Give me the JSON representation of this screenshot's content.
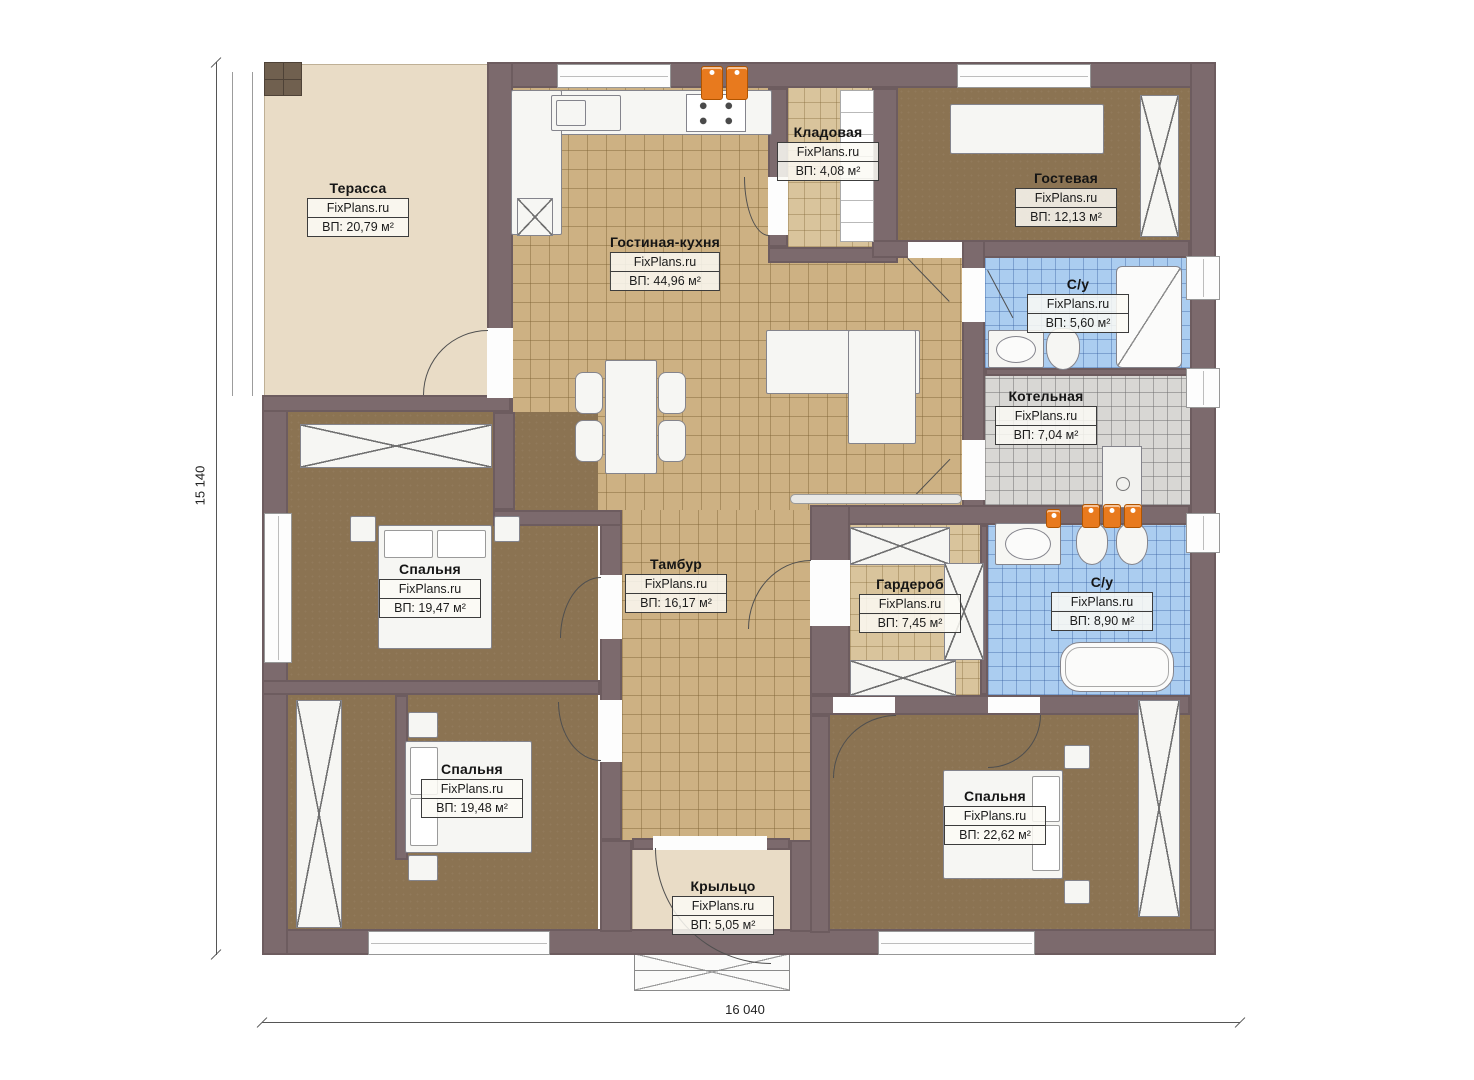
{
  "brand": "FixPlans.ru",
  "dimensions": {
    "height_label": "15 140",
    "width_label": "16 040"
  },
  "rooms": [
    {
      "name": "Терасса",
      "brand": "FixPlans.ru",
      "area": "ВП: 20,79 м²"
    },
    {
      "name": "Гостиная-кухня",
      "brand": "FixPlans.ru",
      "area": "ВП: 44,96 м²"
    },
    {
      "name": "Кладовая",
      "brand": "FixPlans.ru",
      "area": "ВП: 4,08 м²"
    },
    {
      "name": "Гостевая",
      "brand": "FixPlans.ru",
      "area": "ВП: 12,13 м²"
    },
    {
      "name": "С/у",
      "brand": "FixPlans.ru",
      "area": "ВП: 5,60 м²"
    },
    {
      "name": "Котельная",
      "brand": "FixPlans.ru",
      "area": "ВП: 7,04 м²"
    },
    {
      "name": "Спальня",
      "brand": "FixPlans.ru",
      "area": "ВП: 19,47 м²"
    },
    {
      "name": "Тамбур",
      "brand": "FixPlans.ru",
      "area": "ВП: 16,17 м²"
    },
    {
      "name": "Гардероб",
      "brand": "FixPlans.ru",
      "area": "ВП: 7,45 м²"
    },
    {
      "name": "С/у",
      "brand": "FixPlans.ru",
      "area": "ВП: 8,90 м²"
    },
    {
      "name": "Спальня",
      "brand": "FixPlans.ru",
      "area": "ВП: 19,48 м²"
    },
    {
      "name": "Спальня",
      "brand": "FixPlans.ru",
      "area": "ВП: 22,62 м²"
    },
    {
      "name": "Крыльцо",
      "brand": "FixPlans.ru",
      "area": "ВП: 5,05 м²"
    }
  ],
  "colors": {
    "wall": "#7c6a6d",
    "tile_tan": "#cdb183",
    "tile_light": "#d9c49c",
    "bath_blue": "#abcdf0",
    "boiler_gray": "#d8d7d4",
    "carpet_brown": "#8b7352",
    "terrace_beige": "#e9dcc6",
    "heater_orange": "#e87a1e"
  }
}
